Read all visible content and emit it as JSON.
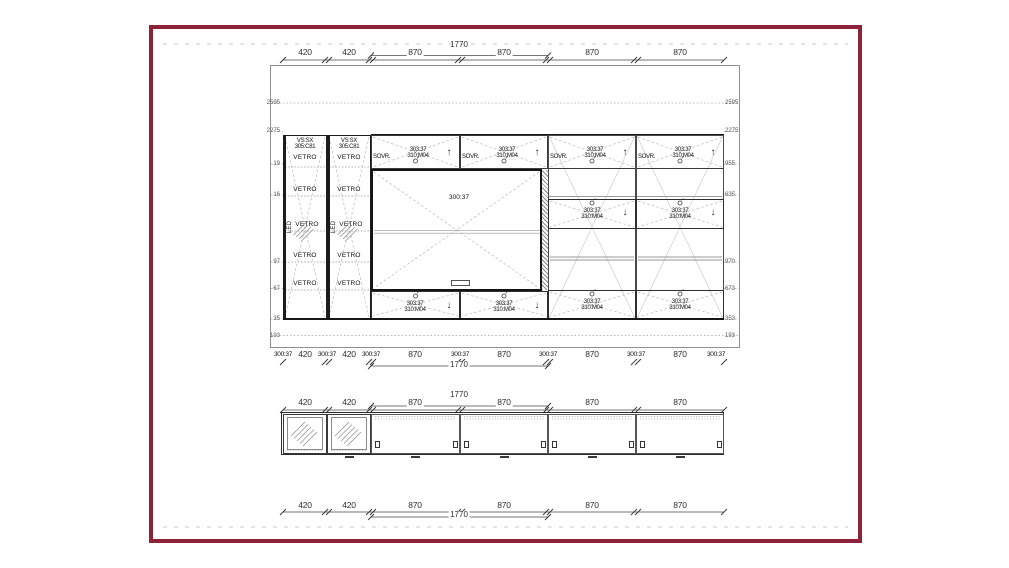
{
  "frame": {
    "border_color": "#8e2238"
  },
  "icons": {
    "arrow_up": "↑",
    "arrow_down": "↓"
  },
  "elevation": {
    "top_dim": {
      "segments": [
        "420",
        "420",
        "870",
        "870",
        "870",
        "870"
      ],
      "overall": "1770"
    },
    "levels_left": [
      "2595",
      "2275",
      "19",
      "16",
      "97",
      "67",
      "35",
      "193"
    ],
    "levels_right": [
      "2595",
      "2275",
      "955",
      "635",
      "970",
      "673",
      "353",
      "193"
    ],
    "towers": [
      {
        "code_line1": "VS:SX",
        "code_line2": "305:C81",
        "led": "LED",
        "shelves": [
          "VETRO",
          "VETRO",
          "VETRO",
          "VETRO",
          "VETRO"
        ]
      },
      {
        "code_line1": "VS:SX",
        "code_line2": "305:C81",
        "led": "LED",
        "shelves": [
          "VETRO",
          "VETRO",
          "VETRO",
          "VETRO",
          "VETRO"
        ]
      }
    ],
    "top_cells": [
      {
        "side_label": "SOVR.",
        "code1": "303:37",
        "code2": "310:M04"
      },
      {
        "side_label": "SOVR.",
        "code1": "303:37",
        "code2": "310:M04"
      },
      {
        "side_label": "SOVR.",
        "code1": "303:37",
        "code2": "310:M04"
      },
      {
        "side_label": "SOVR.",
        "code1": "303:37",
        "code2": "310:M04"
      }
    ],
    "tv_area": {
      "label": "300:37"
    },
    "mid_bottom_cells": [
      {
        "code1": "303:37",
        "code2": "310:M04"
      },
      {
        "code1": "303:37",
        "code2": "310:M04"
      }
    ],
    "right_drop_cells": [
      {
        "code1": "303:37",
        "code2": "310:M04"
      },
      {
        "code1": "303:37",
        "code2": "310:M04"
      }
    ],
    "right_bottom_cells": [
      {
        "code1": "303:37",
        "code2": "310:M04"
      },
      {
        "code1": "303:37",
        "code2": "310:M04"
      }
    ],
    "bottom_dim": {
      "panel_codes": [
        "300:37",
        "300:37",
        "300:37",
        "300:37",
        "300:37",
        "300:37",
        "300:37"
      ],
      "segments": [
        "420",
        "420",
        "870",
        "870",
        "870",
        "870"
      ],
      "overall": "1770"
    }
  },
  "plan": {
    "top_dim": {
      "segments": [
        "420",
        "420",
        "870",
        "870",
        "870",
        "870"
      ],
      "overall": "1770"
    },
    "bottom_dim": {
      "segments": [
        "420",
        "420",
        "870",
        "870",
        "870",
        "870"
      ],
      "overall": "1770"
    }
  }
}
